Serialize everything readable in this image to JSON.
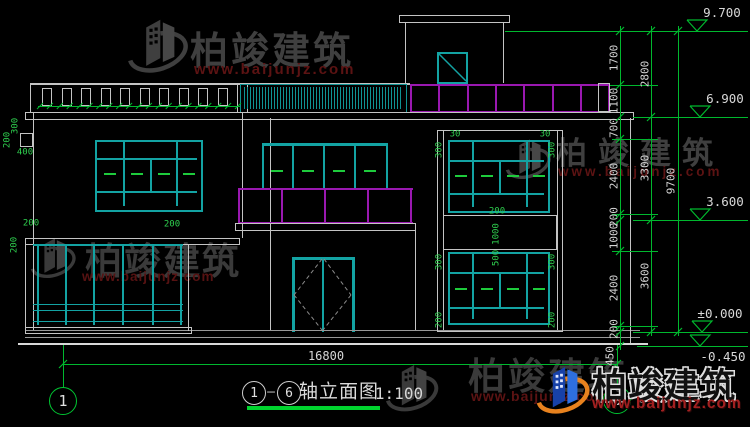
{
  "title_block": {
    "axis_left": "1",
    "dash": "—",
    "axis_right": "6",
    "name": "轴立面图",
    "scale": "1:100"
  },
  "axis_bubbles": {
    "left": "1",
    "right": "6"
  },
  "dimensions": {
    "total_width": "16800",
    "total_height": "9700",
    "outer_chain": [
      "2800",
      "3300",
      "3600"
    ],
    "inner_chain": [
      "1700",
      "1100",
      "700",
      "2400",
      "200",
      "1000",
      "2400",
      "200",
      "450"
    ],
    "left": {
      "v300": "300",
      "v200": "200",
      "v400": "400",
      "h200": "200"
    },
    "window": {
      "v30": "30",
      "v300": "300",
      "v200": "200",
      "v1000": "1000",
      "v500": "500"
    }
  },
  "elevations": {
    "roof": "9.700",
    "second_roof": "6.900",
    "second_floor": "3.600",
    "ground": "±0.000",
    "site": "-0.450"
  },
  "watermark": {
    "brand": "柏竣建筑",
    "url": "www.baijunjz.com"
  },
  "colors": {
    "line": "#c4c4c4",
    "teal": "#13a3a3",
    "magenta": "#9a18b0",
    "dim_green": "#00b82e",
    "wm_gray": "#3f3f3f",
    "wm_red": "#5c1313",
    "logo_blue": "#2e6fe0",
    "logo_orange": "#e8821e"
  }
}
